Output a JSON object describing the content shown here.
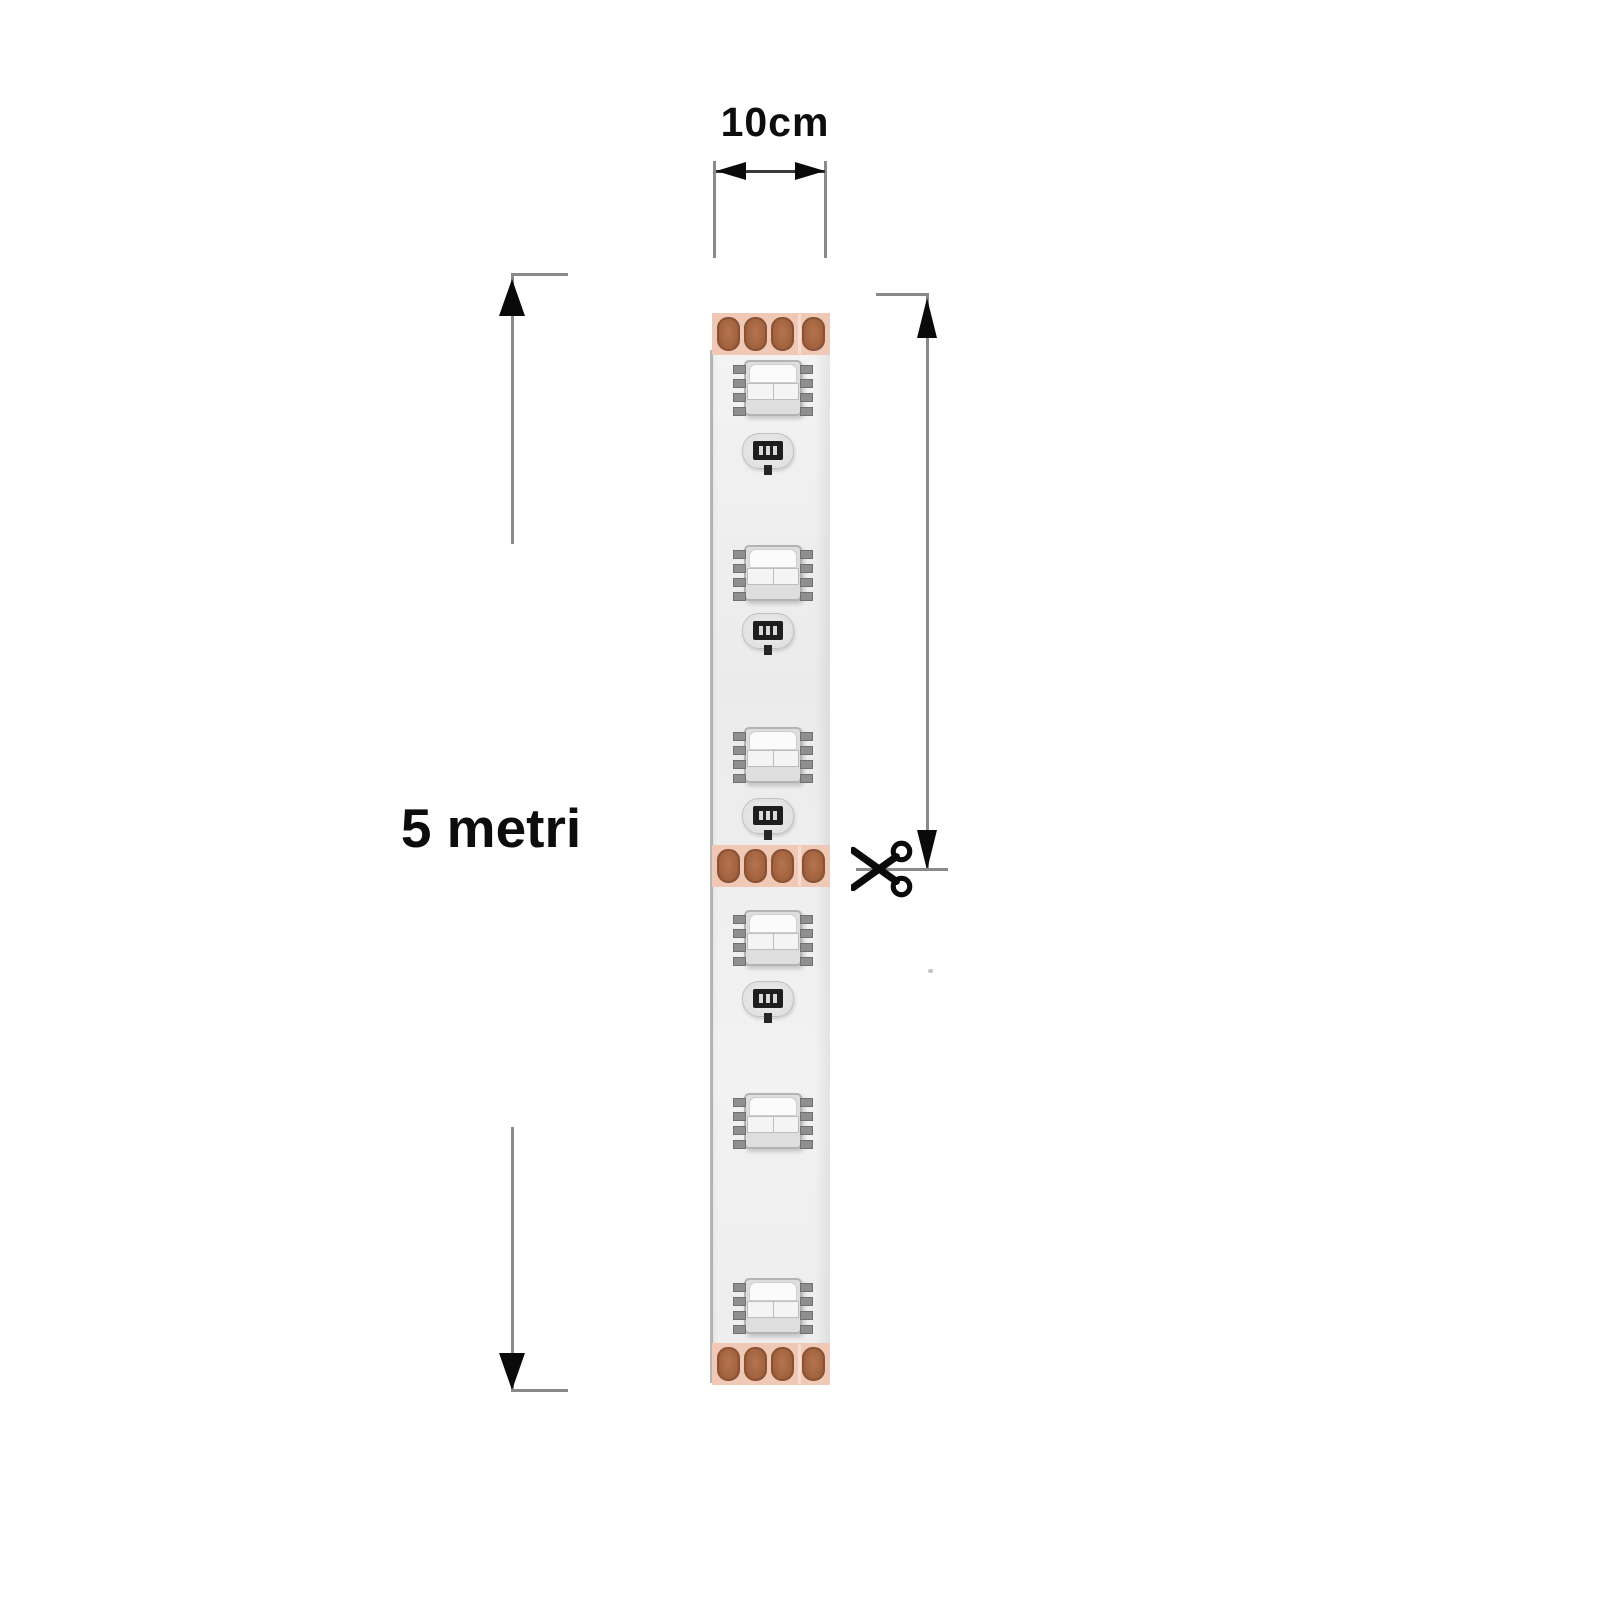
{
  "annotations": {
    "top_dimension_label": "10cm",
    "side_dimension_label": "5 metri"
  },
  "icons": {
    "cut": "scissors-icon",
    "dimension_arrows": [
      "arrow-left-icon",
      "arrow-right-icon",
      "arrow-up-icon",
      "arrow-down-icon"
    ]
  },
  "strip": {
    "description": "flexible LED strip shown vertically",
    "solder_pad_rows": 3,
    "pads_per_row": 4,
    "led_count": 6,
    "resistor_count": 4
  },
  "colors": {
    "background": "#ffffff",
    "dimension_line": "#8a8a8a",
    "arrow_ink": "#0a0a0a",
    "text_ink": "#0d0d0d",
    "strip_body": "#efefef",
    "strip_edge_shadow": "#9e9e9e",
    "pad_row_background": "#f0c8b6",
    "pad_copper": "#aa6c49",
    "pad_copper_edge": "#8a5134",
    "led_body": "#dedede",
    "led_border": "#b3b3b3",
    "led_pin": "#8f8f8f",
    "resistor_body": "#1e1e1e"
  }
}
